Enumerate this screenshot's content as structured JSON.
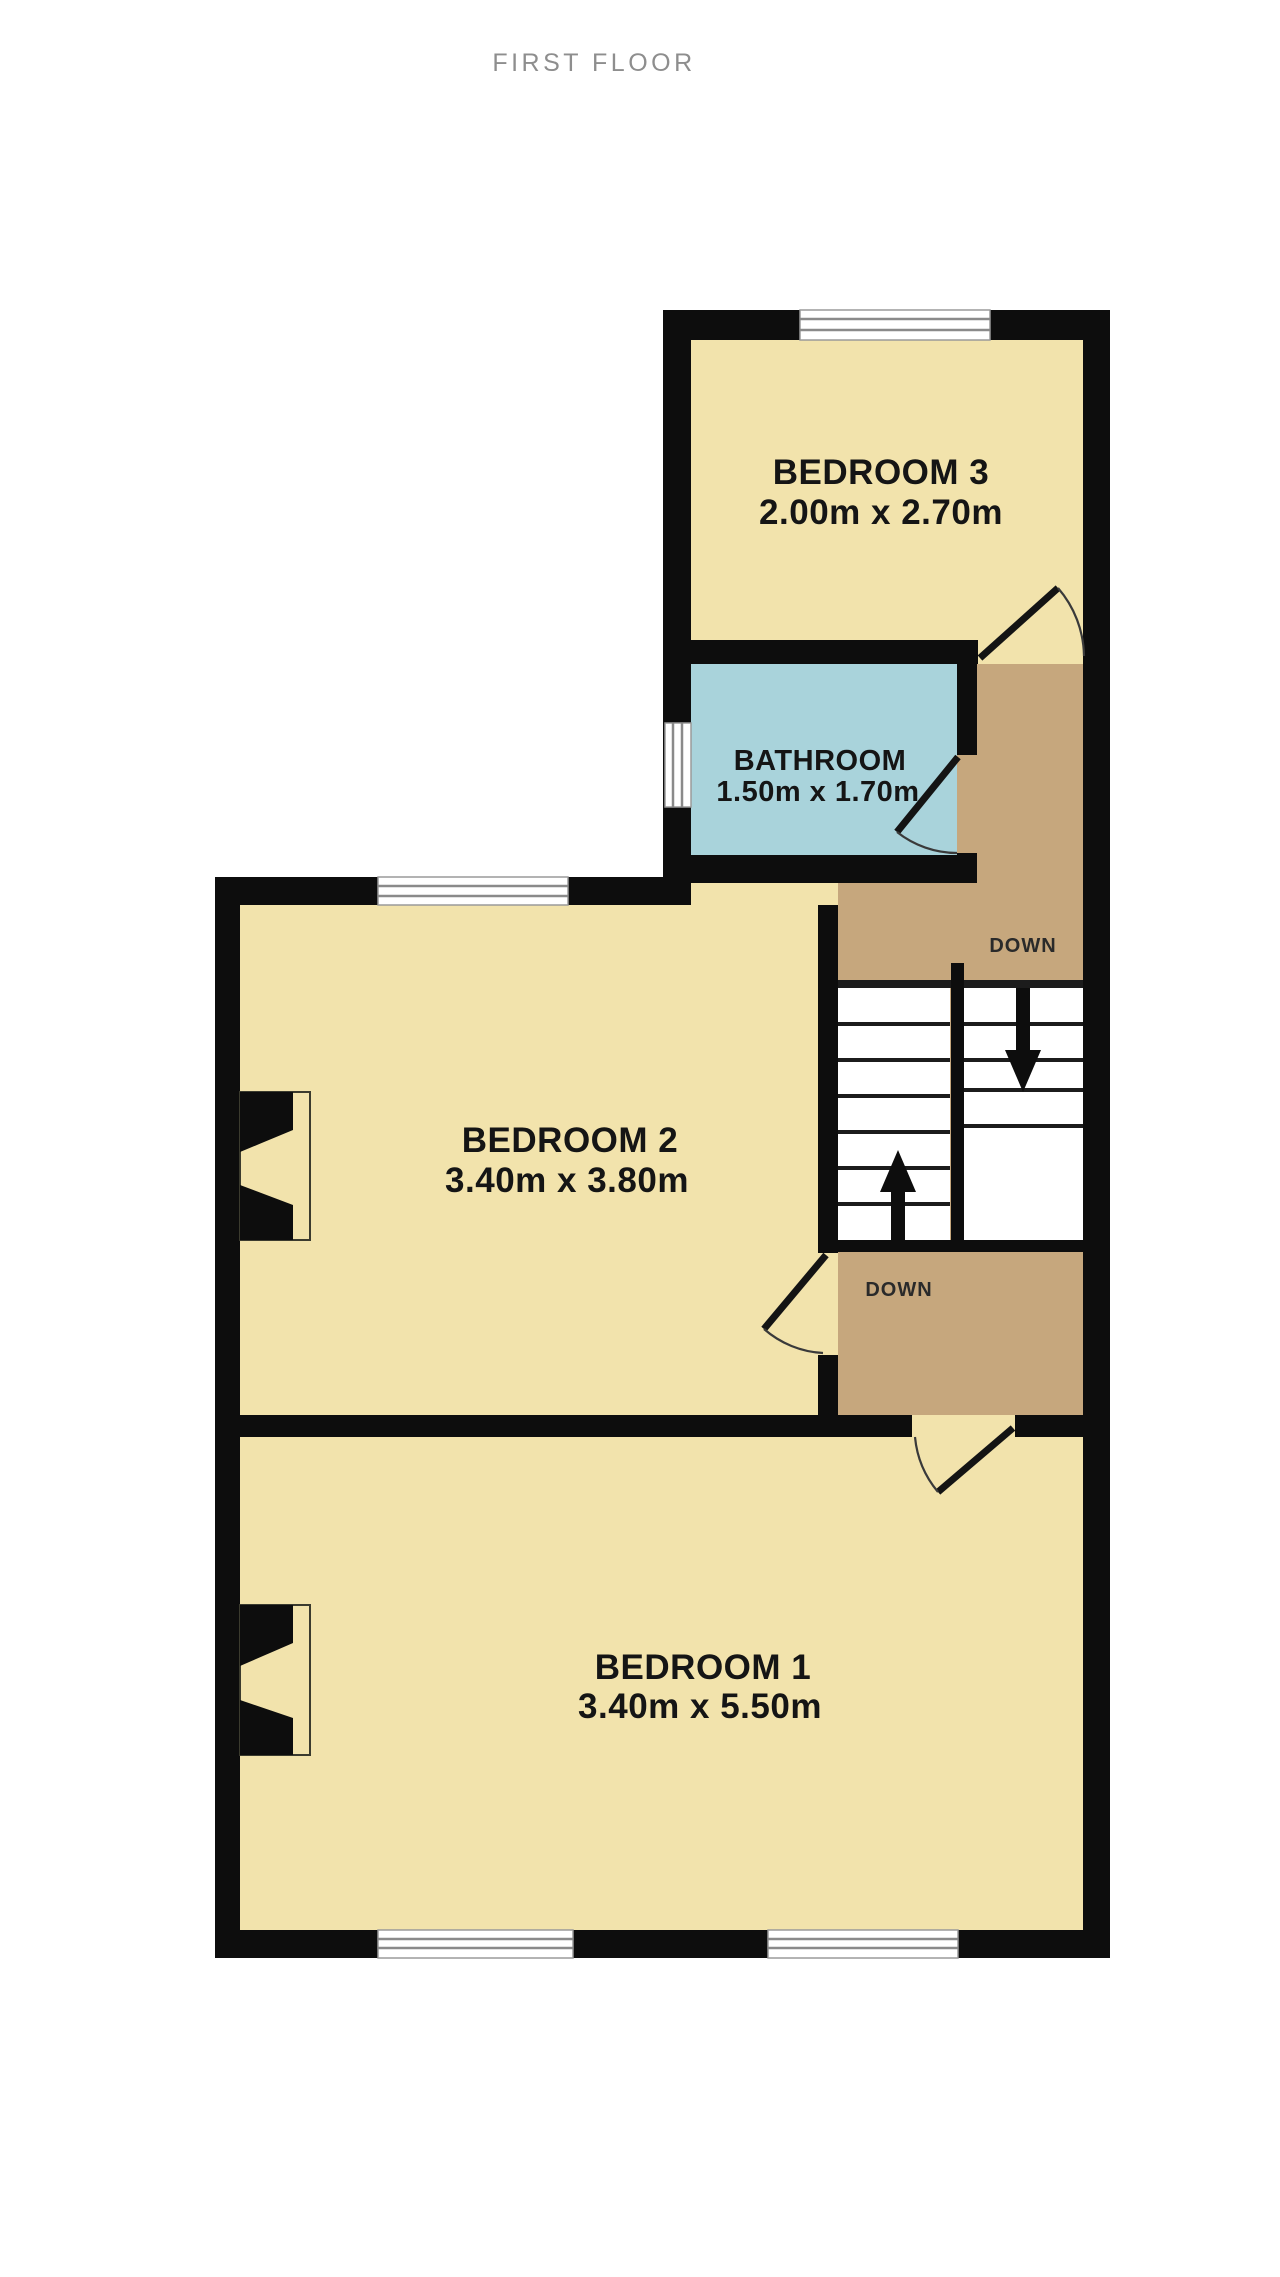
{
  "title": "FIRST FLOOR",
  "floor_plan": {
    "rooms": [
      {
        "name": "BEDROOM 3",
        "dims": "2.00m x 2.70m"
      },
      {
        "name": "BATHROOM",
        "dims": "1.50m x 1.70m"
      },
      {
        "name": "BEDROOM 2",
        "dims": "3.40m x 3.80m"
      },
      {
        "name": "BEDROOM 1",
        "dims": "3.40m x 5.50m"
      }
    ],
    "stairs": {
      "upper_label": "DOWN",
      "lower_label": "DOWN"
    },
    "colors": {
      "room_fill": "#F2E3AC",
      "bathroom_fill": "#A9D3DB",
      "landing_fill": "#C6A77D",
      "wall": "#0d0d0d",
      "title_text": "#8e8e8e",
      "label_text": "#151515"
    }
  }
}
